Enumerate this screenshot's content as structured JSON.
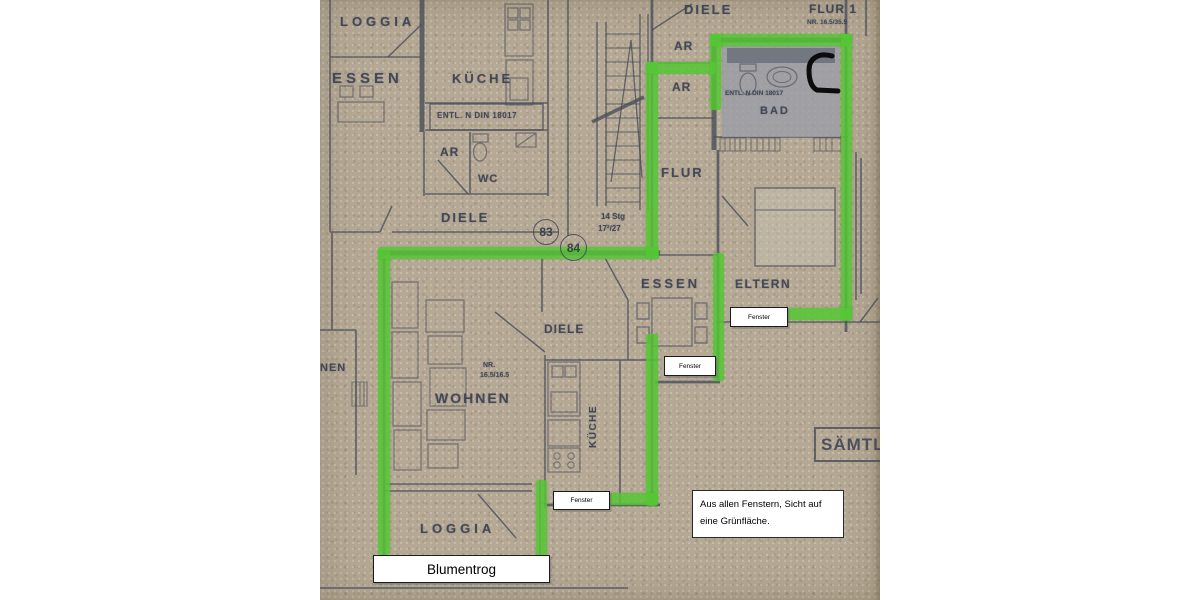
{
  "plan": {
    "colors": {
      "paper": "#b5a995",
      "line": "#474b59",
      "highlight": "#55c734",
      "badfill": "#9b9ea8",
      "ink": "#0c0c0c"
    },
    "labels": {
      "loggia_top": "LOGGIA",
      "essen_left": "ESSEN",
      "kueche_top": "KÜCHE",
      "entl_kueche": "ENTL. N DIN 18017",
      "ar_left": "AR",
      "wc": "WC",
      "diele_left": "DIELE",
      "unit_83": "83",
      "unit_84": "84",
      "stairs_1": "14 Stg",
      "stairs_2": "17²/27",
      "diele_top_right": "DIELE",
      "flur1": "FLUR 1",
      "flur1_nr": "NR. 16.5/35.5",
      "ar_top": "AR",
      "ar_bottom": "AR",
      "entl_bad": "ENTL. N DIN 18017",
      "bad": "BAD",
      "flur": "FLUR",
      "essen_mid": "ESSEN",
      "eltern": "ELTERN",
      "diele_mid": "DIELE",
      "nr_wohnen_1": "NR.",
      "nr_wohnen_2": "16.5/16.5",
      "wohnen": "WOHNEN",
      "kueche_vertical": "KÜCHE",
      "nen_partial": "NEN",
      "saemtl_partial": "SÄMTL",
      "loggia_bottom": "LOGGIA"
    },
    "annotations": {
      "fenster_eltern": "Fenster",
      "fenster_essen": "Fenster",
      "fenster_loggia": "Fenster",
      "blumentrog": "Blumentrog",
      "note_1": "Aus allen Fenstern, Sicht auf",
      "note_2": "eine Grünfläche."
    }
  }
}
